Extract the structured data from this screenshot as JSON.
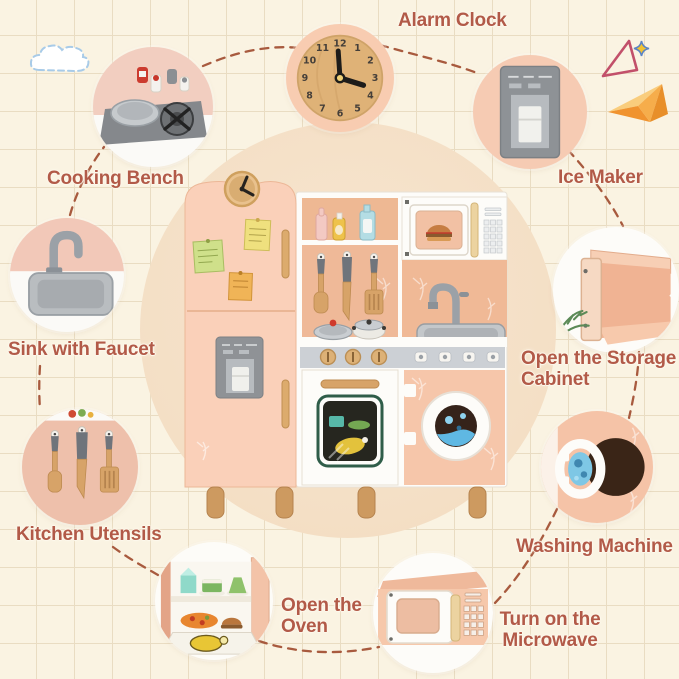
{
  "colors": {
    "background": "#faf3e2",
    "grid_line": "#e9dcc2",
    "backdrop_circle": "#f4dfc5",
    "label_text": "#b25a48",
    "dash_line": "#a85a3e",
    "kitchen_peach": "#f7c9ad",
    "kitchen_white": "#fdfcf9",
    "wood": "#d7a368",
    "steel_grey": "#9ba1a7"
  },
  "clock": {
    "numbers": [
      "12",
      "1",
      "2",
      "3",
      "4",
      "5",
      "6",
      "7",
      "8",
      "9",
      "10",
      "11"
    ]
  },
  "callouts": {
    "alarm_clock": {
      "label": "Alarm Clock"
    },
    "cooking_bench": {
      "label": "Cooking Bench"
    },
    "ice_maker": {
      "label": "Ice Maker"
    },
    "storage_cabinet": {
      "label": "Open the Storage\nCabinet"
    },
    "sink": {
      "label": "Sink with Faucet"
    },
    "utensils": {
      "label": "Kitchen Utensils"
    },
    "washing_machine": {
      "label": "Washing Machine"
    },
    "microwave": {
      "label": "Turn on the\nMicrowave"
    },
    "oven": {
      "label": "Open the\nOven"
    }
  },
  "icons": [
    "cloud-icon",
    "triangle-doodle-icon",
    "sparkle-icon",
    "paper-plane-icon"
  ]
}
